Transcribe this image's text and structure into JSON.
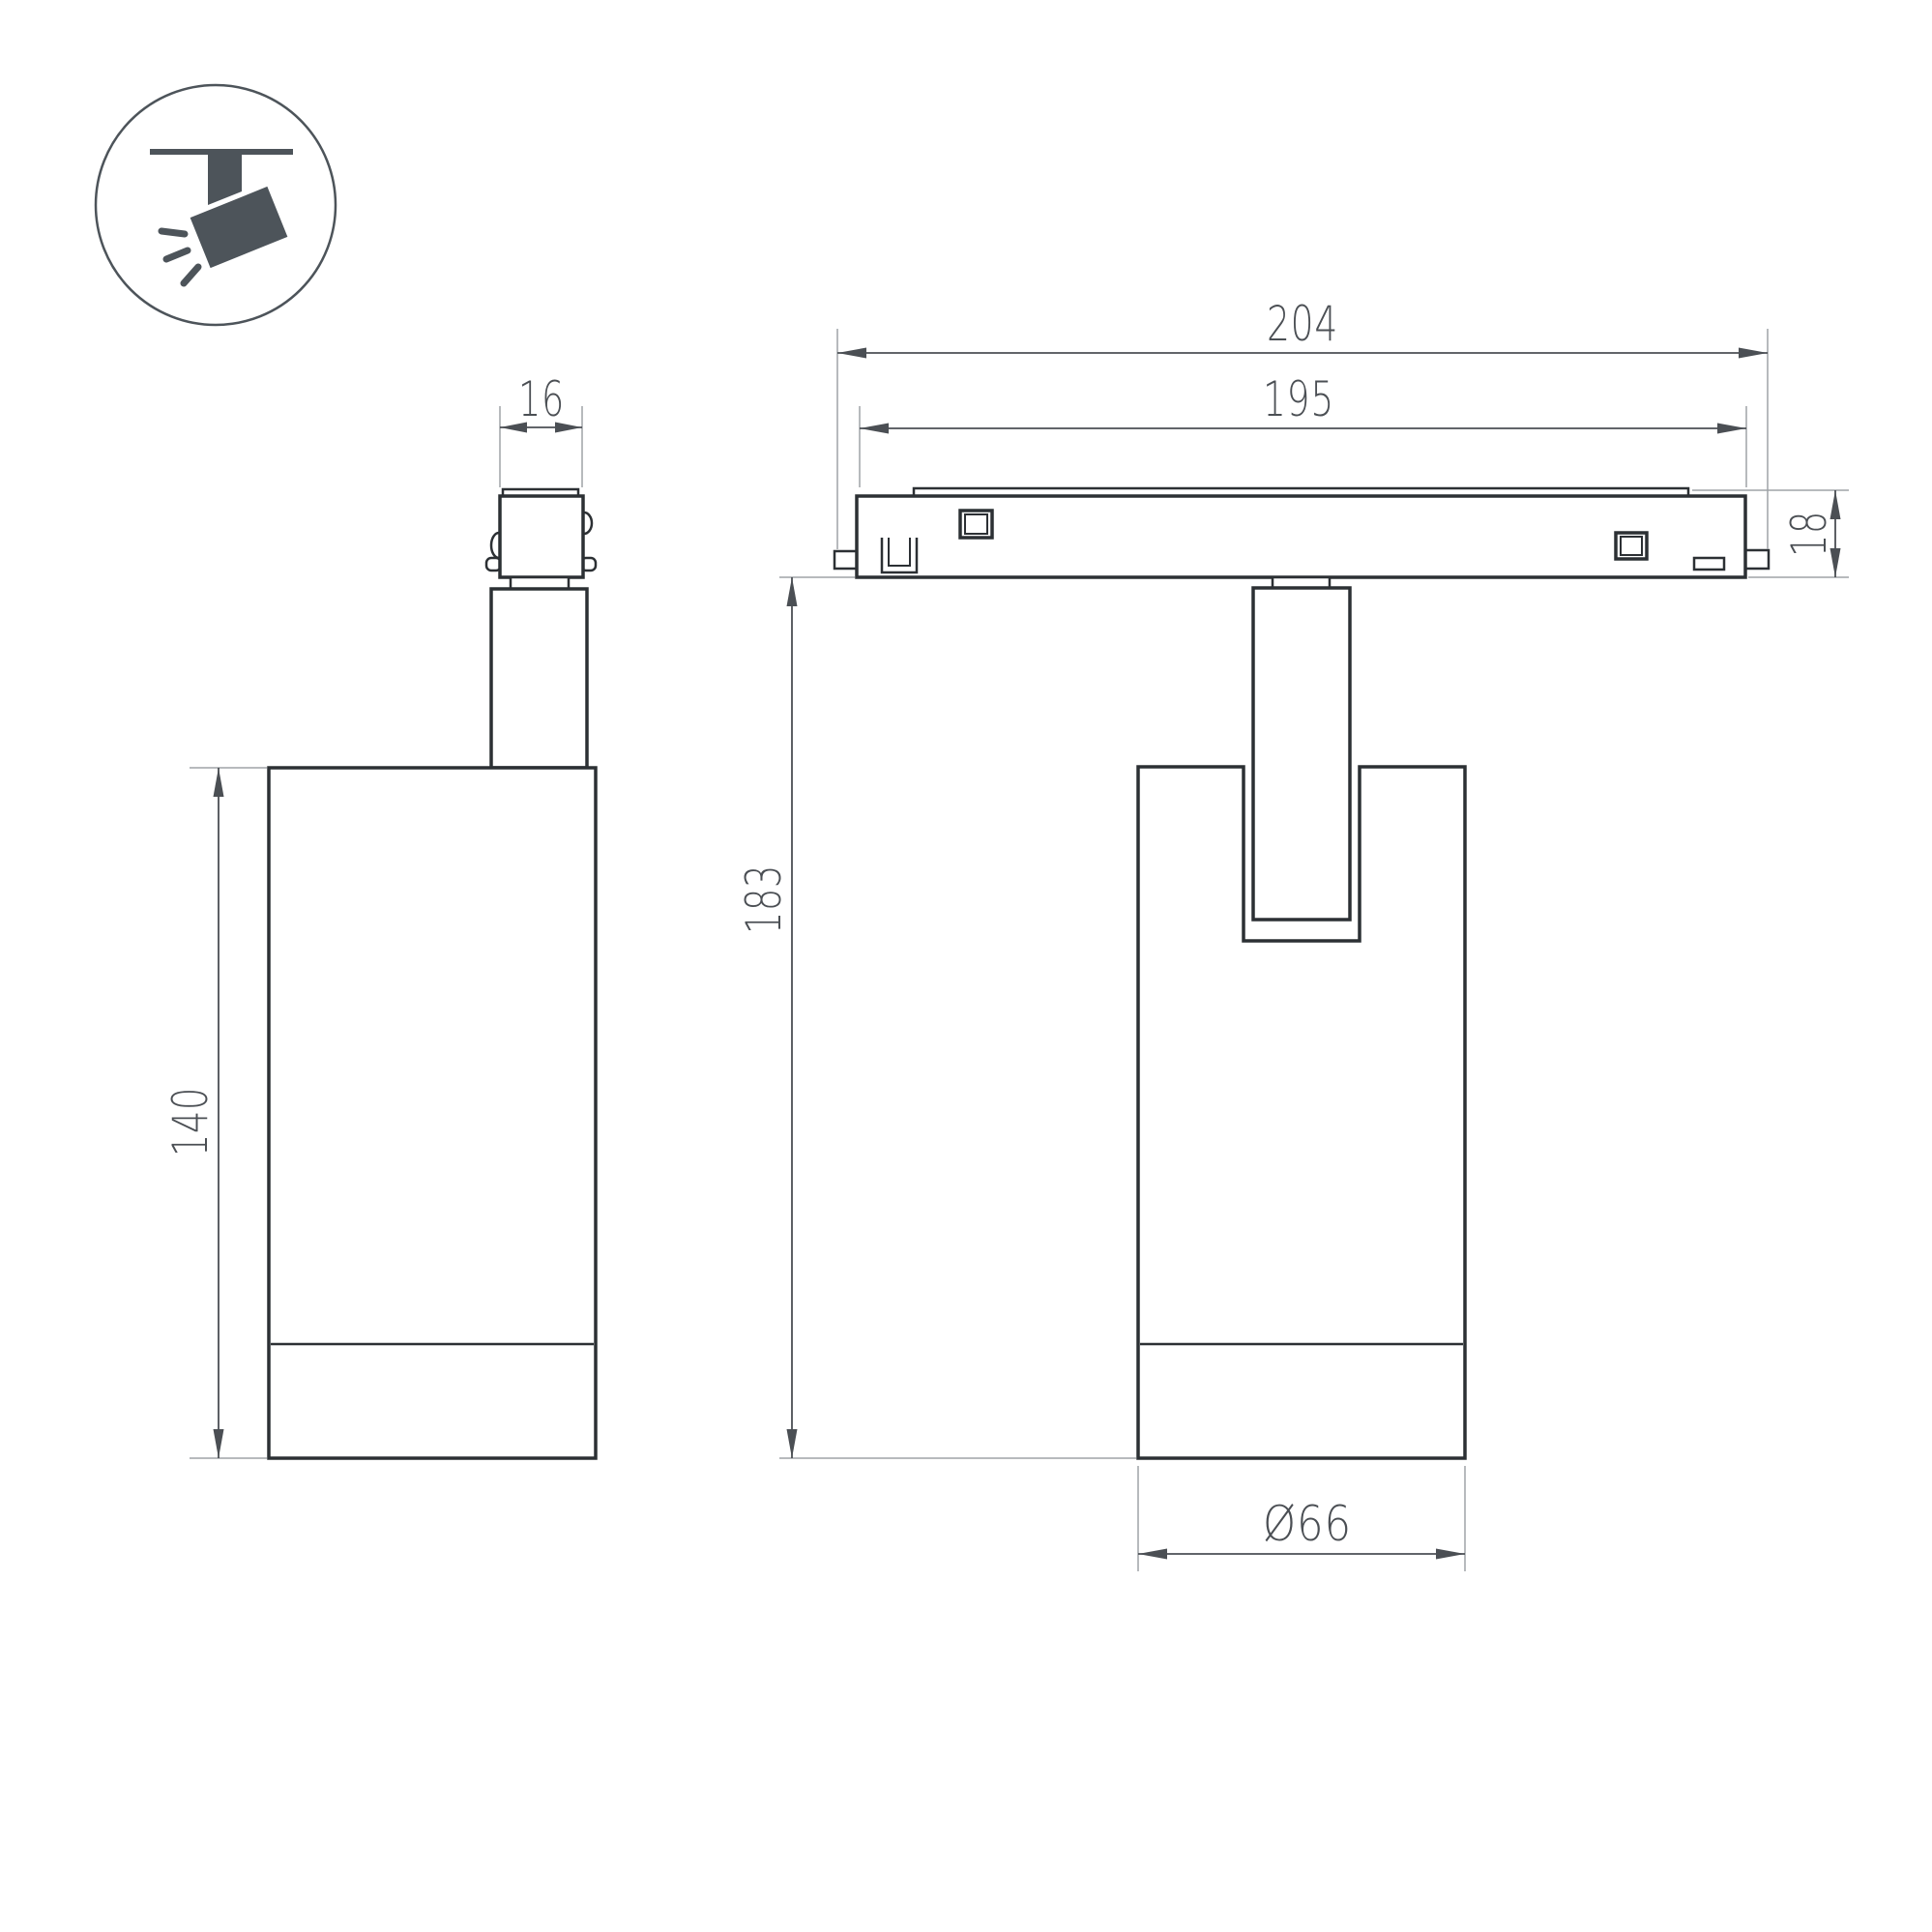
{
  "drawing": {
    "side_view": {
      "connector_width": "16",
      "body_height": "140"
    },
    "front_view": {
      "track_length_outer": "204",
      "track_length_inner": "195",
      "track_height": "18",
      "overall_height": "183",
      "body_diameter": "Ø66"
    }
  },
  "icon": {
    "name": "track-spotlight-icon"
  },
  "colors": {
    "outline": "#2c3034",
    "dimension": "#4b4f54",
    "extension": "#9fa3a7",
    "icon": "#4d545a",
    "background": "#ffffff"
  }
}
